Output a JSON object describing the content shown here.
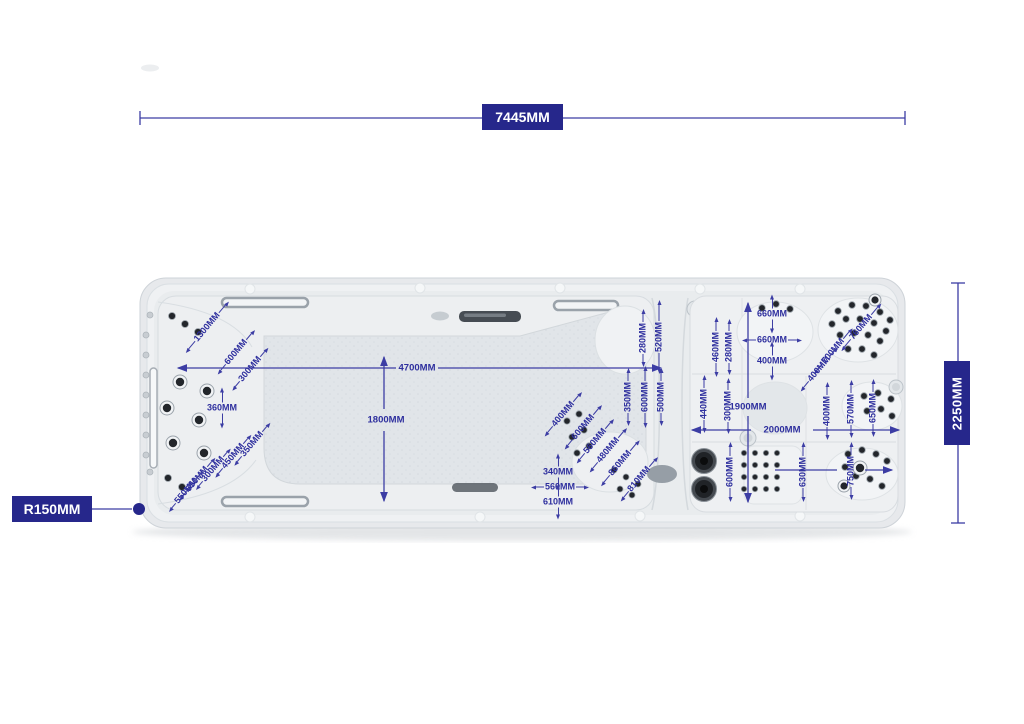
{
  "page": {
    "background": "#ffffff"
  },
  "colors": {
    "dimension_box": "#26278b",
    "dimension_text": "#2e2f9e",
    "dimension_line": "#3c3da4",
    "spa_shell": "#e8eaec",
    "spa_floor": "#e0e4e8"
  },
  "overall_dimensions": {
    "length": {
      "label": "7445MM"
    },
    "width": {
      "label": "2250MM"
    },
    "corner_radius": {
      "label": "R150MM"
    }
  },
  "annotations": [
    {
      "label": "1300MM",
      "x": 207,
      "y": 327,
      "rot": -50,
      "mode": "along",
      "len": 10
    },
    {
      "label": "600MM",
      "x": 236,
      "y": 352,
      "rot": -50,
      "mode": "along",
      "len": 8
    },
    {
      "label": "300MM",
      "x": 250,
      "y": 369,
      "rot": -50,
      "mode": "along",
      "len": 7
    },
    {
      "label": "360MM",
      "x": 222,
      "y": 408,
      "rot": 0,
      "mode": "cross",
      "len": 10
    },
    {
      "label": "350MM",
      "x": 252,
      "y": 444,
      "rot": -50,
      "mode": "along",
      "len": 7
    },
    {
      "label": "450MM",
      "x": 233,
      "y": 456,
      "rot": -50,
      "mode": "along",
      "len": 7
    },
    {
      "label": "300MM",
      "x": 213,
      "y": 469,
      "rot": -50,
      "mode": "along",
      "len": 6
    },
    {
      "label": "650MM",
      "x": 197,
      "y": 479,
      "rot": -50,
      "mode": "along",
      "len": 7
    },
    {
      "label": "550MM",
      "x": 186,
      "y": 491,
      "rot": -50,
      "mode": "along",
      "len": 6
    },
    {
      "label": "4700MM",
      "x": 417,
      "y": 368,
      "rot": 0,
      "mode": "none"
    },
    {
      "label": "1800MM",
      "x": 386,
      "y": 420,
      "rot": 0,
      "mode": "none"
    },
    {
      "label": "280MM",
      "x": 643,
      "y": 338,
      "rot": -90,
      "mode": "along",
      "len": 8
    },
    {
      "label": "520MM",
      "x": 659,
      "y": 337,
      "rot": -90,
      "mode": "along",
      "len": 16
    },
    {
      "label": "350MM",
      "x": 628,
      "y": 397,
      "rot": -90,
      "mode": "along",
      "len": 8
    },
    {
      "label": "600MM",
      "x": 645,
      "y": 397,
      "rot": -90,
      "mode": "along",
      "len": 10
    },
    {
      "label": "500MM",
      "x": 661,
      "y": 397,
      "rot": -90,
      "mode": "along",
      "len": 8
    },
    {
      "label": "400MM",
      "x": 563,
      "y": 414,
      "rot": -50,
      "mode": "along",
      "len": 8
    },
    {
      "label": "600MM",
      "x": 583,
      "y": 427,
      "rot": -50,
      "mode": "along",
      "len": 8
    },
    {
      "label": "560MM",
      "x": 595,
      "y": 441,
      "rot": -50,
      "mode": "along",
      "len": 8
    },
    {
      "label": "480MM",
      "x": 608,
      "y": 450,
      "rot": -50,
      "mode": "along",
      "len": 8
    },
    {
      "label": "860MM",
      "x": 620,
      "y": 463,
      "rot": -50,
      "mode": "along",
      "len": 9
    },
    {
      "label": "810MM",
      "x": 639,
      "y": 479,
      "rot": -50,
      "mode": "along",
      "len": 8
    },
    {
      "label": "340MM",
      "x": 558,
      "y": 472,
      "rot": 0,
      "mode": "cross",
      "len": 8
    },
    {
      "label": "560MM",
      "x": 560,
      "y": 487,
      "rot": 0,
      "mode": "along",
      "len": 8
    },
    {
      "label": "610MM",
      "x": 558,
      "y": 502,
      "rot": 0,
      "mode": "cross",
      "len": 7
    },
    {
      "label": "660MM",
      "x": 772,
      "y": 314,
      "rot": 0,
      "mode": "cross",
      "len": 9
    },
    {
      "label": "660MM",
      "x": 772,
      "y": 340,
      "rot": 0,
      "mode": "along",
      "len": 9
    },
    {
      "label": "400MM",
      "x": 772,
      "y": 361,
      "rot": 0,
      "mode": "cross",
      "len": 9
    },
    {
      "label": "460MM",
      "x": 716,
      "y": 347,
      "rot": -90,
      "mode": "along",
      "len": 9
    },
    {
      "label": "280MM",
      "x": 729,
      "y": 347,
      "rot": -90,
      "mode": "along",
      "len": 7
    },
    {
      "label": "440MM",
      "x": 704,
      "y": 404,
      "rot": -90,
      "mode": "along",
      "len": 8
    },
    {
      "label": "300MM",
      "x": 728,
      "y": 406,
      "rot": -90,
      "mode": "along",
      "len": 7
    },
    {
      "label": "1900MM",
      "x": 748,
      "y": 407,
      "rot": 0,
      "mode": "none"
    },
    {
      "label": "2000MM",
      "x": 782,
      "y": 430,
      "rot": 0,
      "mode": "none"
    },
    {
      "label": "700MM",
      "x": 833,
      "y": 351,
      "rot": -50,
      "mode": "along",
      "len": 9
    },
    {
      "label": "400MM",
      "x": 819,
      "y": 369,
      "rot": -50,
      "mode": "along",
      "len": 8
    },
    {
      "label": "760MM",
      "x": 861,
      "y": 327,
      "rot": -50,
      "mode": "along",
      "len": 10
    },
    {
      "label": "400MM",
      "x": 827,
      "y": 411,
      "rot": -90,
      "mode": "along",
      "len": 8
    },
    {
      "label": "570MM",
      "x": 851,
      "y": 409,
      "rot": -90,
      "mode": "along",
      "len": 8
    },
    {
      "label": "650MM",
      "x": 873,
      "y": 408,
      "rot": -90,
      "mode": "along",
      "len": 8
    },
    {
      "label": "600MM",
      "x": 730,
      "y": 472,
      "rot": -90,
      "mode": "along",
      "len": 9
    },
    {
      "label": "630MM",
      "x": 803,
      "y": 472,
      "rot": -90,
      "mode": "along",
      "len": 9
    },
    {
      "label": "750MM",
      "x": 851,
      "y": 471,
      "rot": -90,
      "mode": "along",
      "len": 8
    }
  ]
}
